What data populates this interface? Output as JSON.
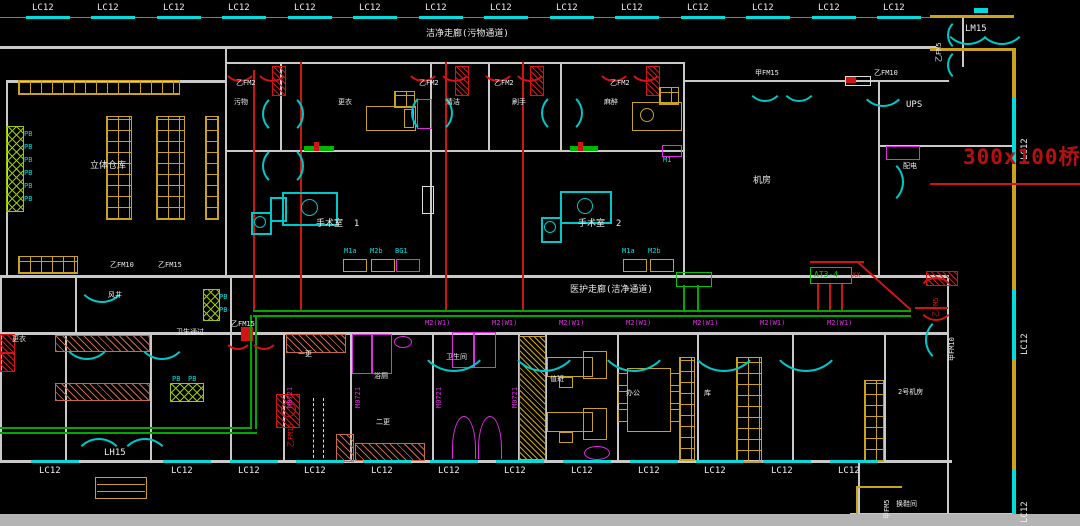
{
  "drawing": {
    "kind": "CAD electrical floor plan",
    "background": "#000000"
  },
  "colors": {
    "wall": "#c9c9c9",
    "wall_yellow": "#c9a21e",
    "window_cyan": "#00dcdc",
    "door_cyan": "#00c8c8",
    "circuit_red": "#cf1414",
    "tray_green": "#00a800",
    "furniture_yellow": "#c9a21e",
    "fixture_magenta": "#e02ce0",
    "annotation_red": "#b51010",
    "hatch_green": "#9ec800",
    "locker_brown": "#c76a4a"
  },
  "notes": {
    "cable_tray": "300x100桥架",
    "panel": "AT3-4",
    "corridor_top": "洁净走廊(污物通道)",
    "corridor_mid": "医护走廊(洁净通道)"
  },
  "annotations": [
    {
      "t": "LC12",
      "x": 32,
      "y": 4,
      "cls": "aw",
      "n": "window-label",
      "bar": [
        -6,
        12,
        44,
        3
      ]
    },
    {
      "t": "LC12",
      "x": 97,
      "y": 4,
      "cls": "aw",
      "n": "window-label",
      "bar": [
        -6,
        12,
        44,
        3
      ]
    },
    {
      "t": "LC12",
      "x": 163,
      "y": 4,
      "cls": "aw",
      "n": "window-label",
      "bar": [
        -6,
        12,
        44,
        3
      ]
    },
    {
      "t": "LC12",
      "x": 228,
      "y": 4,
      "cls": "aw",
      "n": "window-label",
      "bar": [
        -6,
        12,
        44,
        3
      ]
    },
    {
      "t": "LC12",
      "x": 294,
      "y": 4,
      "cls": "aw",
      "n": "window-label",
      "bar": [
        -6,
        12,
        44,
        3
      ]
    },
    {
      "t": "LC12",
      "x": 359,
      "y": 4,
      "cls": "aw",
      "n": "window-label",
      "bar": [
        -6,
        12,
        44,
        3
      ]
    },
    {
      "t": "LC12",
      "x": 425,
      "y": 4,
      "cls": "aw",
      "n": "window-label",
      "bar": [
        -6,
        12,
        44,
        3
      ]
    },
    {
      "t": "LC12",
      "x": 490,
      "y": 4,
      "cls": "aw",
      "n": "window-label",
      "bar": [
        -6,
        12,
        44,
        3
      ]
    },
    {
      "t": "LC12",
      "x": 556,
      "y": 4,
      "cls": "aw",
      "n": "window-label",
      "bar": [
        -6,
        12,
        44,
        3
      ]
    },
    {
      "t": "LC12",
      "x": 621,
      "y": 4,
      "cls": "aw",
      "n": "window-label",
      "bar": [
        -6,
        12,
        44,
        3
      ]
    },
    {
      "t": "LC12",
      "x": 687,
      "y": 4,
      "cls": "aw",
      "n": "window-label",
      "bar": [
        -6,
        12,
        44,
        3
      ]
    },
    {
      "t": "LC12",
      "x": 752,
      "y": 4,
      "cls": "aw",
      "n": "window-label",
      "bar": [
        -6,
        12,
        44,
        3
      ]
    },
    {
      "t": "LC12",
      "x": 818,
      "y": 4,
      "cls": "aw",
      "n": "window-label",
      "bar": [
        -6,
        12,
        44,
        3
      ]
    },
    {
      "t": "LC12",
      "x": 883,
      "y": 4,
      "cls": "aw",
      "n": "window-label",
      "bar": [
        -6,
        12,
        44,
        3
      ]
    },
    {
      "t": "LC12",
      "x": 39,
      "y": 467,
      "cls": "aw",
      "n": "window-label",
      "bar": [
        -8,
        -7,
        48,
        3
      ]
    },
    {
      "t": "LC12",
      "x": 171,
      "y": 467,
      "cls": "aw",
      "n": "window-label",
      "bar": [
        -8,
        -7,
        48,
        3
      ]
    },
    {
      "t": "LC12",
      "x": 238,
      "y": 467,
      "cls": "aw",
      "n": "window-label",
      "bar": [
        -8,
        -7,
        48,
        3
      ]
    },
    {
      "t": "LC12",
      "x": 304,
      "y": 467,
      "cls": "aw",
      "n": "window-label",
      "bar": [
        -8,
        -7,
        48,
        3
      ]
    },
    {
      "t": "LC12",
      "x": 371,
      "y": 467,
      "cls": "aw",
      "n": "window-label",
      "bar": [
        -8,
        -7,
        48,
        3
      ]
    },
    {
      "t": "LC12",
      "x": 438,
      "y": 467,
      "cls": "aw",
      "n": "window-label",
      "bar": [
        -8,
        -7,
        48,
        3
      ]
    },
    {
      "t": "LC12",
      "x": 504,
      "y": 467,
      "cls": "aw",
      "n": "window-label",
      "bar": [
        -8,
        -7,
        48,
        3
      ]
    },
    {
      "t": "LC12",
      "x": 571,
      "y": 467,
      "cls": "aw",
      "n": "window-label",
      "bar": [
        -8,
        -7,
        48,
        3
      ]
    },
    {
      "t": "LC12",
      "x": 638,
      "y": 467,
      "cls": "aw",
      "n": "window-label",
      "bar": [
        -8,
        -7,
        48,
        3
      ]
    },
    {
      "t": "LC12",
      "x": 704,
      "y": 467,
      "cls": "aw",
      "n": "window-label",
      "bar": [
        -8,
        -7,
        48,
        3
      ]
    },
    {
      "t": "LC12",
      "x": 771,
      "y": 467,
      "cls": "aw",
      "n": "window-label",
      "bar": [
        -8,
        -7,
        48,
        3
      ]
    },
    {
      "t": "LC12",
      "x": 838,
      "y": 467,
      "cls": "aw",
      "n": "window-label",
      "bar": [
        -8,
        -7,
        48,
        3
      ]
    },
    {
      "t": "LH15",
      "x": 104,
      "y": 449,
      "cls": "aw",
      "n": "entrance-label"
    },
    {
      "t": "LM15",
      "x": 965,
      "y": 25,
      "cls": "aw",
      "n": "entrance-label"
    },
    {
      "t": "LC12",
      "x": 1021,
      "y": 160,
      "cls": "aw",
      "n": "window-label",
      "v": 1
    },
    {
      "t": "LC12",
      "x": 1021,
      "y": 355,
      "cls": "aw",
      "n": "window-label",
      "v": 1
    },
    {
      "t": "LC12",
      "x": 1021,
      "y": 523,
      "cls": "aw",
      "n": "window-label",
      "v": 1
    },
    {
      "t": "乙FM5",
      "x": 936,
      "y": 62,
      "cls": "asm",
      "n": "door-label",
      "v": 1
    },
    {
      "t": "300x100桥架",
      "x": 963,
      "y": 147,
      "cls": "big",
      "n": "cable-tray-note"
    },
    {
      "t": "洁净走廊(污物通道)",
      "x": 426,
      "y": 30,
      "cls": "aw",
      "n": "corridor-label"
    },
    {
      "t": "医护走廊(洁净通道)",
      "x": 570,
      "y": 286,
      "cls": "aw",
      "n": "corridor-label"
    },
    {
      "t": "AT3-4",
      "x": 814,
      "y": 271,
      "cls": "ag",
      "n": "panel-label"
    },
    {
      "t": "XX",
      "x": 852,
      "y": 272,
      "cls": "asr",
      "n": "panel-note"
    },
    {
      "t": "甲FM15",
      "x": 755,
      "y": 70,
      "cls": "asm",
      "n": "door-label"
    },
    {
      "t": "乙FM10",
      "x": 874,
      "y": 70,
      "cls": "asm",
      "n": "door-label"
    },
    {
      "t": "乙FM10",
      "x": 110,
      "y": 262,
      "cls": "asm",
      "n": "door-label"
    },
    {
      "t": "乙FM15",
      "x": 158,
      "y": 262,
      "cls": "asm",
      "n": "door-label"
    },
    {
      "t": "乙FM2",
      "x": 236,
      "y": 80,
      "cls": "asm",
      "n": "door-label"
    },
    {
      "t": "乙FM2",
      "x": 419,
      "y": 80,
      "cls": "asm",
      "n": "door-label"
    },
    {
      "t": "乙FM2",
      "x": 494,
      "y": 80,
      "cls": "asm",
      "n": "door-label"
    },
    {
      "t": "乙FM2",
      "x": 610,
      "y": 80,
      "cls": "asm",
      "n": "door-label"
    },
    {
      "t": "乙FM15",
      "x": 231,
      "y": 321,
      "cls": "asm",
      "n": "door-label"
    },
    {
      "t": "乙FM15",
      "x": 288,
      "y": 447,
      "cls": "asr",
      "n": "door-label",
      "v": 1
    },
    {
      "t": "乙FM5",
      "x": 933,
      "y": 317,
      "cls": "asr",
      "n": "door-label",
      "v": 1
    },
    {
      "t": "甲FM10",
      "x": 949,
      "y": 361,
      "cls": "asm",
      "n": "door-label",
      "v": 1
    },
    {
      "t": "甲FM5",
      "x": 884,
      "y": 519,
      "cls": "asm",
      "n": "door-label",
      "v": 1
    },
    {
      "t": "立体仓库",
      "x": 90,
      "y": 162,
      "cls": "aw",
      "n": "room-label"
    },
    {
      "t": "污物",
      "x": 234,
      "y": 99,
      "cls": "asm",
      "n": "room-label"
    },
    {
      "t": "更衣",
      "x": 338,
      "y": 99,
      "cls": "asm",
      "n": "room-label"
    },
    {
      "t": "清洁",
      "x": 446,
      "y": 99,
      "cls": "asm",
      "n": "room-label"
    },
    {
      "t": "刷手",
      "x": 512,
      "y": 99,
      "cls": "asm",
      "n": "room-label"
    },
    {
      "t": "麻醉",
      "x": 604,
      "y": 99,
      "cls": "asm",
      "n": "room-label"
    },
    {
      "t": "手术室  1",
      "x": 316,
      "y": 220,
      "cls": "aw",
      "n": "room-label"
    },
    {
      "t": "手术室  2",
      "x": 578,
      "y": 220,
      "cls": "aw",
      "n": "room-label"
    },
    {
      "t": "机房",
      "x": 753,
      "y": 177,
      "cls": "aw",
      "n": "room-label"
    },
    {
      "t": "UPS",
      "x": 906,
      "y": 101,
      "cls": "aw",
      "n": "room-label"
    },
    {
      "t": "配电",
      "x": 903,
      "y": 163,
      "cls": "asm",
      "n": "room-label"
    },
    {
      "t": "风井",
      "x": 108,
      "y": 292,
      "cls": "asm",
      "n": "room-label"
    },
    {
      "t": "卫生通过",
      "x": 176,
      "y": 329,
      "cls": "asm",
      "n": "room-label"
    },
    {
      "t": "更衣",
      "x": 12,
      "y": 336,
      "cls": "asm",
      "n": "room-label"
    },
    {
      "t": "一更",
      "x": 298,
      "y": 351,
      "cls": "asm",
      "n": "room-label"
    },
    {
      "t": "浴厕",
      "x": 374,
      "y": 373,
      "cls": "asm",
      "n": "room-label"
    },
    {
      "t": "二更",
      "x": 376,
      "y": 419,
      "cls": "asm",
      "n": "room-label"
    },
    {
      "t": "卫生间",
      "x": 446,
      "y": 354,
      "cls": "asm",
      "n": "room-label"
    },
    {
      "t": "值班",
      "x": 550,
      "y": 376,
      "cls": "asm",
      "n": "room-label"
    },
    {
      "t": "办公",
      "x": 626,
      "y": 390,
      "cls": "asm",
      "n": "room-label"
    },
    {
      "t": "库",
      "x": 704,
      "y": 390,
      "cls": "asm",
      "n": "room-label"
    },
    {
      "t": "2号机房",
      "x": 898,
      "y": 389,
      "cls": "asm",
      "n": "room-label"
    },
    {
      "t": "换鞋间",
      "x": 896,
      "y": 501,
      "cls": "asm",
      "n": "room-label"
    },
    {
      "t": "M1a",
      "x": 344,
      "y": 248,
      "cls": "ac",
      "n": "equipment-code"
    },
    {
      "t": "M2b",
      "x": 370,
      "y": 248,
      "cls": "ac",
      "n": "equipment-code"
    },
    {
      "t": "BG1",
      "x": 395,
      "y": 248,
      "cls": "ac",
      "n": "equipment-code"
    },
    {
      "t": "M1a",
      "x": 622,
      "y": 248,
      "cls": "ac",
      "n": "equipment-code"
    },
    {
      "t": "M2b",
      "x": 648,
      "y": 248,
      "cls": "ac",
      "n": "equipment-code"
    },
    {
      "t": "M1",
      "x": 663,
      "y": 157,
      "cls": "ac",
      "n": "equipment-code"
    },
    {
      "t": "PB",
      "x": 24,
      "y": 131,
      "cls": "ac",
      "n": "equipment-code"
    },
    {
      "t": "PB",
      "x": 24,
      "y": 144,
      "cls": "ac",
      "n": "equipment-code"
    },
    {
      "t": "PB",
      "x": 24,
      "y": 157,
      "cls": "ac",
      "n": "equipment-code"
    },
    {
      "t": "PB",
      "x": 24,
      "y": 170,
      "cls": "ac",
      "n": "equipment-code"
    },
    {
      "t": "PB",
      "x": 24,
      "y": 183,
      "cls": "ac",
      "n": "equipment-code"
    },
    {
      "t": "PB",
      "x": 24,
      "y": 196,
      "cls": "ac",
      "n": "equipment-code"
    },
    {
      "t": "PB",
      "x": 219,
      "y": 294,
      "cls": "ac",
      "n": "equipment-code"
    },
    {
      "t": "PB",
      "x": 219,
      "y": 307,
      "cls": "ac",
      "n": "equipment-code"
    },
    {
      "t": "PB",
      "x": 172,
      "y": 376,
      "cls": "ac",
      "n": "equipment-code"
    },
    {
      "t": "PB",
      "x": 188,
      "y": 376,
      "cls": "ac",
      "n": "equipment-code"
    },
    {
      "t": "M2(W1)",
      "x": 425,
      "y": 320,
      "cls": "am",
      "n": "door-code"
    },
    {
      "t": "M2(W1)",
      "x": 492,
      "y": 320,
      "cls": "am",
      "n": "door-code"
    },
    {
      "t": "M2(W1)",
      "x": 559,
      "y": 320,
      "cls": "am",
      "n": "door-code"
    },
    {
      "t": "M2(W1)",
      "x": 626,
      "y": 320,
      "cls": "am",
      "n": "door-code"
    },
    {
      "t": "M2(W1)",
      "x": 693,
      "y": 320,
      "cls": "am",
      "n": "door-code"
    },
    {
      "t": "M2(W1)",
      "x": 760,
      "y": 320,
      "cls": "am",
      "n": "door-code"
    },
    {
      "t": "M2(W1)",
      "x": 827,
      "y": 320,
      "cls": "am",
      "n": "door-code"
    },
    {
      "t": "M0721",
      "x": 287,
      "y": 408,
      "cls": "am",
      "n": "door-code",
      "v": 1
    },
    {
      "t": "M0721",
      "x": 355,
      "y": 408,
      "cls": "am",
      "n": "door-code",
      "v": 1
    },
    {
      "t": "M0721",
      "x": 436,
      "y": 408,
      "cls": "am",
      "n": "door-code",
      "v": 1
    },
    {
      "t": "M0721",
      "x": 512,
      "y": 408,
      "cls": "am",
      "n": "door-code",
      "v": 1
    }
  ]
}
